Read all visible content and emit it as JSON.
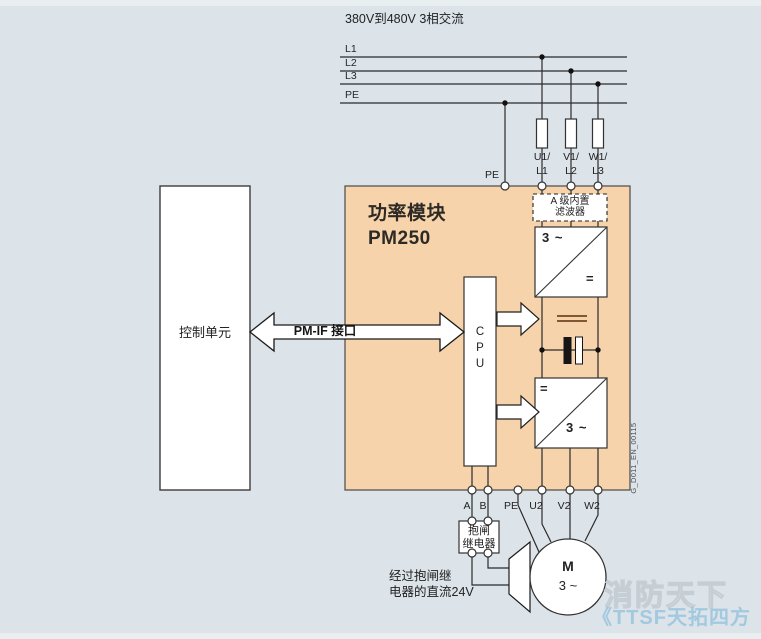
{
  "supply": {
    "title": "380V到480V 3相交流",
    "l1": "L1",
    "l2": "L2",
    "l3": "L3",
    "pe": "PE"
  },
  "control_unit": {
    "label": "控制单元"
  },
  "pm_if": {
    "label": "PM-IF 接口"
  },
  "power_module": {
    "title_line1": "功率模块",
    "title_line2": "PM250"
  },
  "cpu": {
    "l1": "C",
    "l2": "P",
    "l3": "U"
  },
  "filter": {
    "line1": "A 级内置",
    "line2": "滤波器"
  },
  "rectifier": {
    "top_left": "3 ~",
    "bottom_right": "="
  },
  "inverter": {
    "top_left": "=",
    "bottom_right": "3 ~"
  },
  "top_terminals": {
    "pe": "PE",
    "u1a": "U1/",
    "u1b": "L1",
    "v1a": "V1/",
    "v1b": "L2",
    "w1a": "W1/",
    "w1b": "L3"
  },
  "bottom_terminals": {
    "a": "A",
    "b": "B",
    "pe": "PE",
    "u2": "U2",
    "v2": "V2",
    "w2": "W2"
  },
  "brake_relay": {
    "line1": "抱闸",
    "line2": "继电器"
  },
  "brake_note": {
    "line1": "经过抱闸继",
    "line2": "电器的直流24V"
  },
  "motor": {
    "line1": "M",
    "line2": "3 ~"
  },
  "doc_code": "G_D011_EN_00115",
  "watermark": {
    "line1": "消防天下",
    "line2": "《TTSF天拓四方"
  },
  "colors": {
    "background": "#dce3e9",
    "module_fill": "#f7d3ab",
    "line": "#2b2b2b",
    "dc_link": "#5b2e10"
  }
}
